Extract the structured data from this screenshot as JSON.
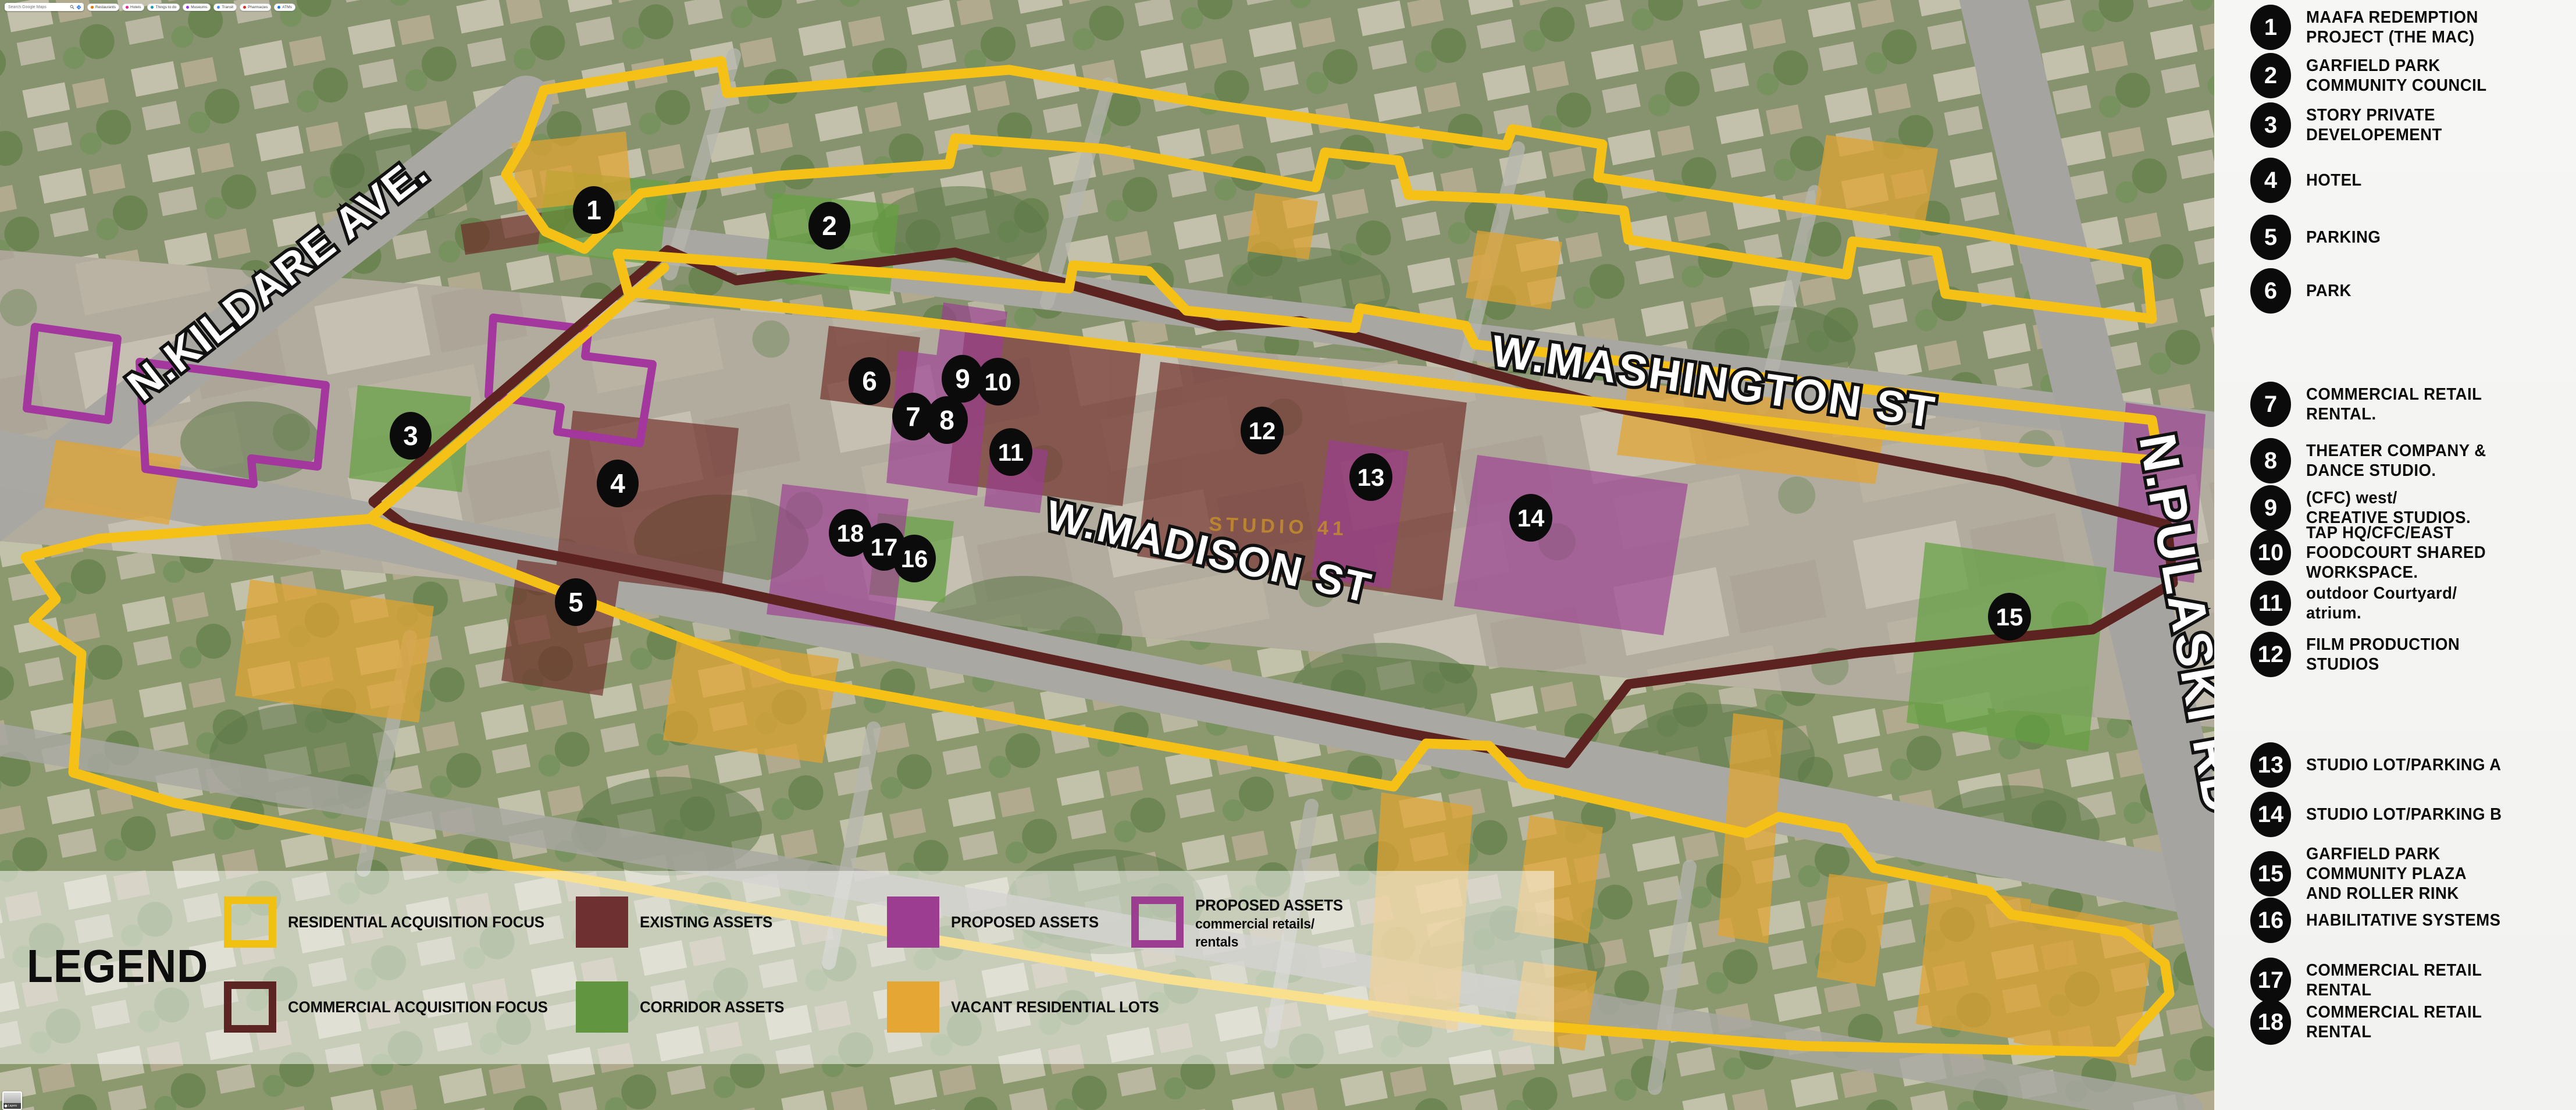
{
  "topbar": {
    "search_placeholder": "Search Google Maps",
    "chips": [
      "Restaurants",
      "Hotels",
      "Things to do",
      "Museums",
      "Transit",
      "Pharmacies",
      "ATMs"
    ]
  },
  "map": {
    "street_labels": {
      "kildare": "N.KILDARE AVE.",
      "washington": "W.MASHINGTON ST",
      "madison": "W.MADISON ST",
      "pulaski": "N.PULASKI RD"
    },
    "building_label": "STUDIO 41",
    "markers": [
      {
        "num": "1"
      },
      {
        "num": "2"
      },
      {
        "num": "3"
      },
      {
        "num": "4"
      },
      {
        "num": "5"
      },
      {
        "num": "6"
      },
      {
        "num": "7"
      },
      {
        "num": "8"
      },
      {
        "num": "9"
      },
      {
        "num": "10"
      },
      {
        "num": "11"
      },
      {
        "num": "12"
      },
      {
        "num": "13"
      },
      {
        "num": "14"
      },
      {
        "num": "15"
      },
      {
        "num": "16"
      },
      {
        "num": "17"
      },
      {
        "num": "18"
      }
    ]
  },
  "legend": {
    "title": "LEGEND",
    "entries": [
      {
        "label": "RESIDENTIAL ACQUISITION FOCUS",
        "style": "outline",
        "color": "#F0C013"
      },
      {
        "label": "COMMERCIAL ACQUISITION FOCUS",
        "style": "outline",
        "color": "#5C2422"
      },
      {
        "label": "EXISTING ASSETS",
        "style": "fill",
        "color": "#6E3030"
      },
      {
        "label": "CORRIDOR ASSETS",
        "style": "fill",
        "color": "#61953F"
      },
      {
        "label": "PROPOSED ASSETS",
        "style": "fill",
        "color": "#9C3D92"
      },
      {
        "label": "VACANT RESIDENTIAL LOTS",
        "style": "fill",
        "color": "#E5A634"
      },
      {
        "label": "PROPOSED ASSETS",
        "sublabel": "commercial retails/\nrentals",
        "style": "outline",
        "color": "#9C3D92"
      }
    ]
  },
  "sidebar": {
    "items": [
      {
        "num": "1",
        "label": "MAAFA REDEMPTION\nPROJECT (THE MAC)"
      },
      {
        "num": "2",
        "label": "GARFIELD PARK\nCOMMUNITY COUNCIL"
      },
      {
        "num": "3",
        "label": "STORY PRIVATE\nDEVELOPEMENT"
      },
      {
        "num": "4",
        "label": "HOTEL"
      },
      {
        "num": "5",
        "label": "PARKING"
      },
      {
        "num": "6",
        "label": "PARK"
      },
      {
        "num": "7",
        "label": "COMMERCIAL RETAIL\nRENTAL."
      },
      {
        "num": "8",
        "label": "THEATER COMPANY &\nDANCE STUDIO."
      },
      {
        "num": "9",
        "label": "(CFC) west/\nCREATIVE STUDIOS."
      },
      {
        "num": "10",
        "label": "TAP HQ/CFC/EAST\nFOODCOURT SHARED\nWORKSPACE."
      },
      {
        "num": "11",
        "label": "outdoor Courtyard/\natrium."
      },
      {
        "num": "12",
        "label": "FILM PRODUCTION\nSTUDIOS"
      },
      {
        "num": "13",
        "label": "STUDIO LOT/PARKING A"
      },
      {
        "num": "14",
        "label": "STUDIO LOT/PARKING B"
      },
      {
        "num": "15",
        "label": "GARFIELD PARK\nCOMMUNITY PLAZA\nAND ROLLER RINK"
      },
      {
        "num": "16",
        "label": "HABILITATIVE SYSTEMS"
      },
      {
        "num": "17",
        "label": "COMMERCIAL RETAIL\nRENTAL"
      },
      {
        "num": "18",
        "label": "COMMERCIAL RETAIL\nRENTAL"
      }
    ]
  },
  "layers_control": {
    "label": "Layers"
  },
  "colors": {
    "residential_boundary": "#F5C117",
    "commercial_boundary": "#5C2321",
    "existing_assets": "#6E2B26",
    "corridor_assets": "#62A13F",
    "proposed_assets": "#9C3D92",
    "vacant_lots": "#E2A32F"
  }
}
